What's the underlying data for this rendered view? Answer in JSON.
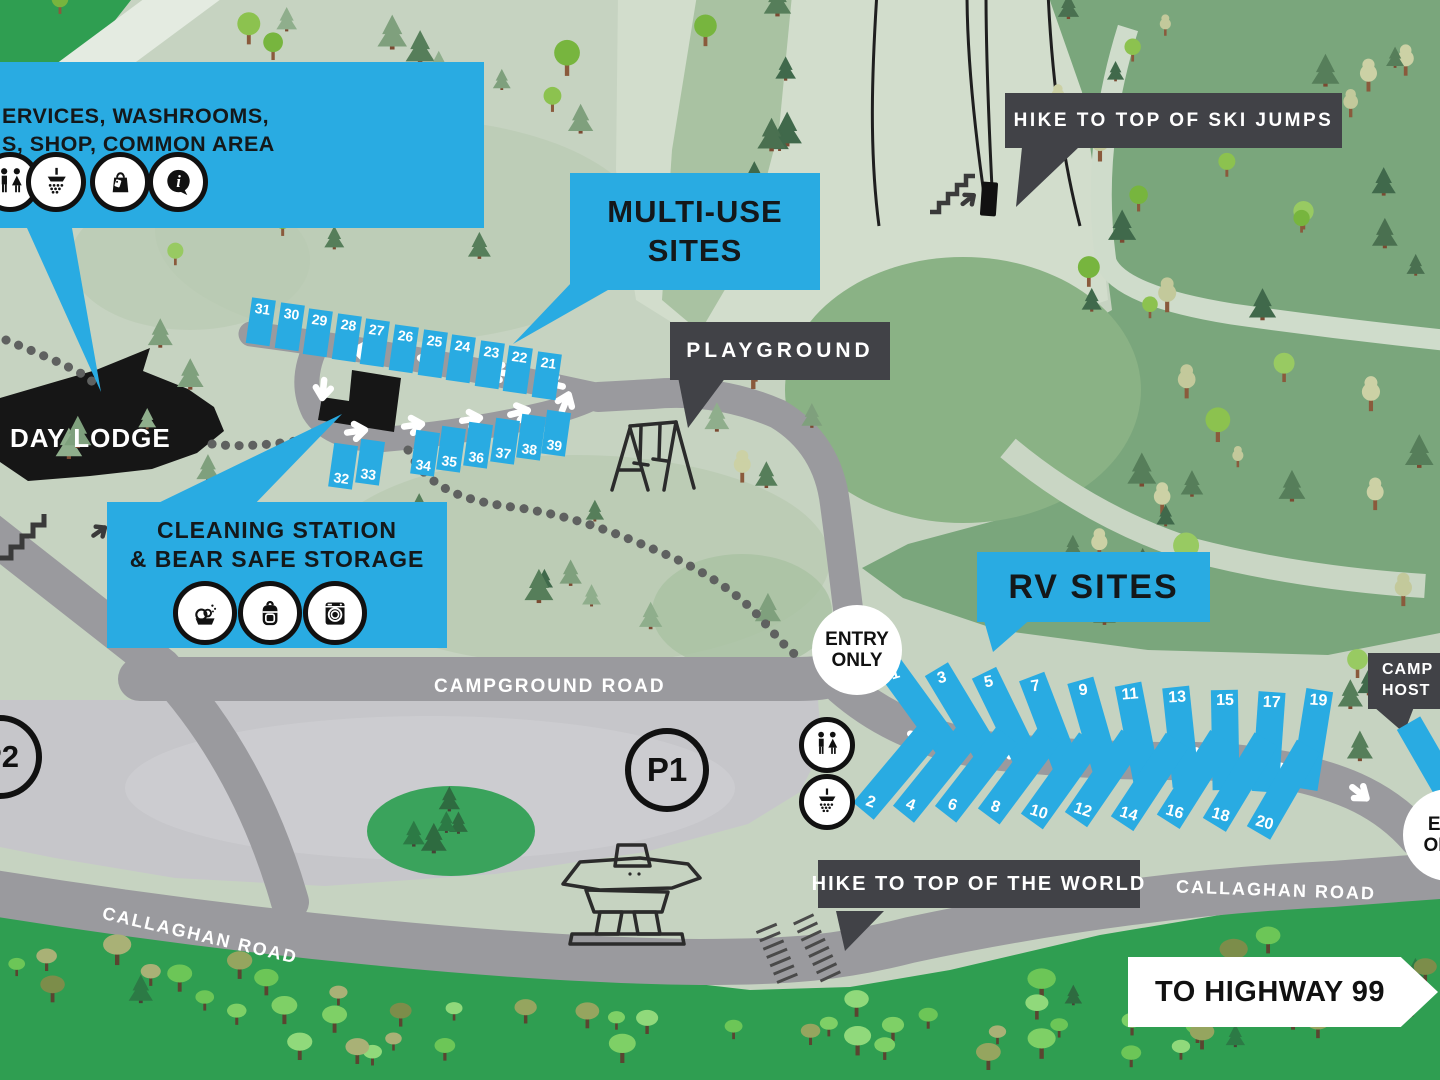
{
  "callouts": {
    "services": {
      "line1": "ERVICES, WASHROOMS,",
      "line2": "S, SHOP, COMMON AREA"
    },
    "multi_use": {
      "line1": "MULTI-USE",
      "line2": "SITES"
    },
    "playground": {
      "label": "PLAYGROUND"
    },
    "ski_jumps": {
      "label": "HIKE TO TOP OF SKI JUMPS"
    },
    "rv_sites": {
      "label": "RV SITES"
    },
    "cleaning": {
      "line1": "CLEANING STATION",
      "line2": "& BEAR SAFE STORAGE"
    },
    "camp_host": {
      "line1": "CAMP",
      "line2": "HOST"
    },
    "top_of_world": {
      "label": "HIKE TO TOP OF THE WORLD"
    }
  },
  "labels": {
    "day_lodge": "DAY LODGE",
    "campground_road": "CAMPGROUND ROAD",
    "callaghan_road_left": "CALLAGHAN ROAD",
    "callaghan_road_right": "CALLAGHAN ROAD",
    "highway_sign": "TO HIGHWAY 99"
  },
  "markers": {
    "entry": {
      "line1": "ENTRY",
      "line2": "ONLY"
    },
    "exit": {
      "line1": "EXIT",
      "line2": "ONLY"
    },
    "parking_1": "P1",
    "parking_2": "P2"
  },
  "sites": {
    "multi_use_top": [
      "31",
      "30",
      "29",
      "28",
      "27",
      "26",
      "25",
      "24",
      "23",
      "22",
      "21"
    ],
    "multi_use_bottom": [
      "32",
      "33",
      "34",
      "35",
      "36",
      "37",
      "38",
      "39"
    ],
    "rv_top": [
      "1",
      "3",
      "5",
      "7",
      "9",
      "11",
      "13",
      "15",
      "17",
      "19"
    ],
    "rv_bottom": [
      "2",
      "4",
      "6",
      "8",
      "10",
      "12",
      "14",
      "16",
      "18",
      "20"
    ]
  },
  "icons": {
    "services": [
      "washrooms-icon",
      "shower-icon",
      "shop-icon",
      "info-icon"
    ],
    "cleaning": [
      "dishwashing-icon",
      "backpack-icon",
      "laundry-icon"
    ],
    "map": [
      "washrooms-icon",
      "shower-icon",
      "playground-swing-icon",
      "inukshuk-icon",
      "stairs-icon"
    ]
  },
  "colors": {
    "accent_blue": "#29abe2",
    "dark_label": "#414247",
    "road_gray": "#9a9a9e",
    "parking_gray": "#c6c6ca",
    "base_green": "#c6d3c1",
    "forest_green": "#7aa67c",
    "bright_green": "#2f9e51",
    "black": "#161616",
    "white": "#ffffff"
  },
  "decor": {
    "tree_fields": [
      {
        "name": "forest-top-right",
        "x": 1055,
        "y": 15,
        "w": 375,
        "h": 610,
        "count": 46,
        "seed": 7,
        "types": [
          [
            "conifer",
            5
          ],
          [
            "pale",
            3
          ],
          [
            "round",
            2
          ]
        ]
      },
      {
        "name": "upper-left",
        "x": 95,
        "y": 20,
        "w": 495,
        "h": 270,
        "count": 22,
        "seed": 11,
        "types": [
          [
            "conifer",
            3
          ],
          [
            "round",
            3
          ],
          [
            "pale",
            1
          ],
          [
            "sage",
            2
          ]
        ]
      },
      {
        "name": "mid-band",
        "x": 700,
        "y": 15,
        "w": 88,
        "h": 305,
        "count": 9,
        "seed": 3,
        "types": [
          [
            "conifer",
            3
          ],
          [
            "round",
            2
          ],
          [
            "pale",
            1
          ]
        ]
      },
      {
        "name": "corner",
        "x": 5,
        "y": 10,
        "w": 120,
        "h": 175,
        "count": 6,
        "seed": 5,
        "types": [
          [
            "round",
            2
          ],
          [
            "pale",
            1
          ],
          [
            "sage",
            1
          ]
        ]
      },
      {
        "name": "multiuse-area",
        "x": 60,
        "y": 335,
        "w": 180,
        "h": 165,
        "count": 6,
        "seed": 13,
        "types": [
          [
            "sage",
            2
          ],
          [
            "conifer",
            1
          ]
        ]
      },
      {
        "name": "mid-forest",
        "x": 390,
        "y": 480,
        "w": 400,
        "h": 155,
        "count": 12,
        "seed": 17,
        "types": [
          [
            "conifer",
            3
          ],
          [
            "sage",
            2
          ],
          [
            "pale",
            1
          ]
        ]
      },
      {
        "name": "ellipse-edge",
        "x": 705,
        "y": 345,
        "w": 140,
        "h": 160,
        "count": 5,
        "seed": 19,
        "types": [
          [
            "round",
            2
          ],
          [
            "sage",
            1
          ]
        ]
      },
      {
        "name": "rv-right",
        "x": 1348,
        "y": 665,
        "w": 88,
        "h": 210,
        "count": 4,
        "seed": 23,
        "types": [
          [
            "conifer",
            2
          ],
          [
            "round",
            1
          ]
        ]
      },
      {
        "name": "island",
        "x": 398,
        "y": 803,
        "w": 110,
        "h": 50,
        "count": 5,
        "seed": 29,
        "types": [
          [
            "darkconifer",
            1
          ]
        ]
      },
      {
        "name": "bottom-1",
        "x": 0,
        "y": 958,
        "w": 300,
        "h": 112,
        "count": 13,
        "seed": 31,
        "types": [
          [
            "kelly",
            3
          ],
          [
            "olive",
            2
          ],
          [
            "darkconifer",
            1
          ]
        ]
      },
      {
        "name": "bottom-2",
        "x": 300,
        "y": 1002,
        "w": 380,
        "h": 70,
        "count": 13,
        "seed": 37,
        "types": [
          [
            "kelly",
            3
          ],
          [
            "olive",
            2
          ],
          [
            "darkconifer",
            1
          ]
        ]
      },
      {
        "name": "bottom-3",
        "x": 680,
        "y": 1014,
        "w": 250,
        "h": 58,
        "count": 8,
        "seed": 41,
        "types": [
          [
            "kelly",
            3
          ],
          [
            "olive",
            1
          ]
        ]
      },
      {
        "name": "bottom-4",
        "x": 950,
        "y": 978,
        "w": 210,
        "h": 95,
        "count": 9,
        "seed": 43,
        "types": [
          [
            "kelly",
            3
          ],
          [
            "olive",
            2
          ],
          [
            "darkconifer",
            1
          ]
        ]
      },
      {
        "name": "bottom-5",
        "x": 1165,
        "y": 940,
        "w": 275,
        "h": 132,
        "count": 12,
        "seed": 47,
        "types": [
          [
            "kelly",
            3
          ],
          [
            "olive",
            2
          ],
          [
            "darkconifer",
            1
          ]
        ]
      }
    ]
  }
}
